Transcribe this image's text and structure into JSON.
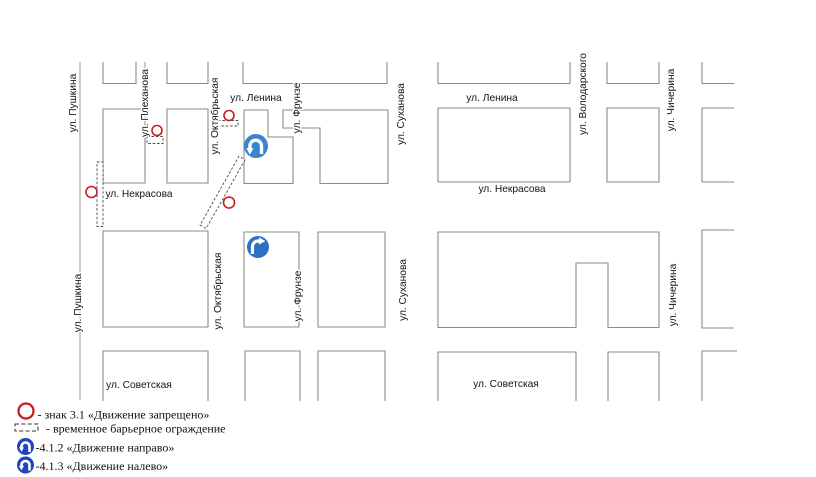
{
  "map": {
    "streets": {
      "pushkina": "ул. Пушкина",
      "plekhanova": "ул. Плеханова",
      "oktyabrskaya": "ул. Октябрьская",
      "frunze": "ул. Фрунзе",
      "sukhanova": "ул. Суханова",
      "volodarskogo": "ул. Володарского",
      "chicherina": "ул. Чичерина",
      "lenina": "ул. Ленина",
      "nekrasova": "ул. Некрасова",
      "sovetskaya": "ул. Советская"
    },
    "icons": [
      "no-entry-sign-icon",
      "turn-left-sign-icon",
      "turn-right-sign-icon",
      "temporary-barrier"
    ]
  },
  "legend": {
    "sign_31_label": "- знак 3.1 «Движение запрещено»",
    "barrier_label": "- временное барьерное ограждение",
    "sign_412_label": "-4.1.2 «Движение направо»",
    "sign_413_label": "-4.1.3 «Движение налево»"
  },
  "colors": {
    "prohibition_red": "#c81d1d",
    "mandatory_blue": "#2e6fc4",
    "mandatory_blue_light": "#3b82cf",
    "legend_blue": "#2443bd",
    "block_outline_gray": "#8b8b8b"
  }
}
